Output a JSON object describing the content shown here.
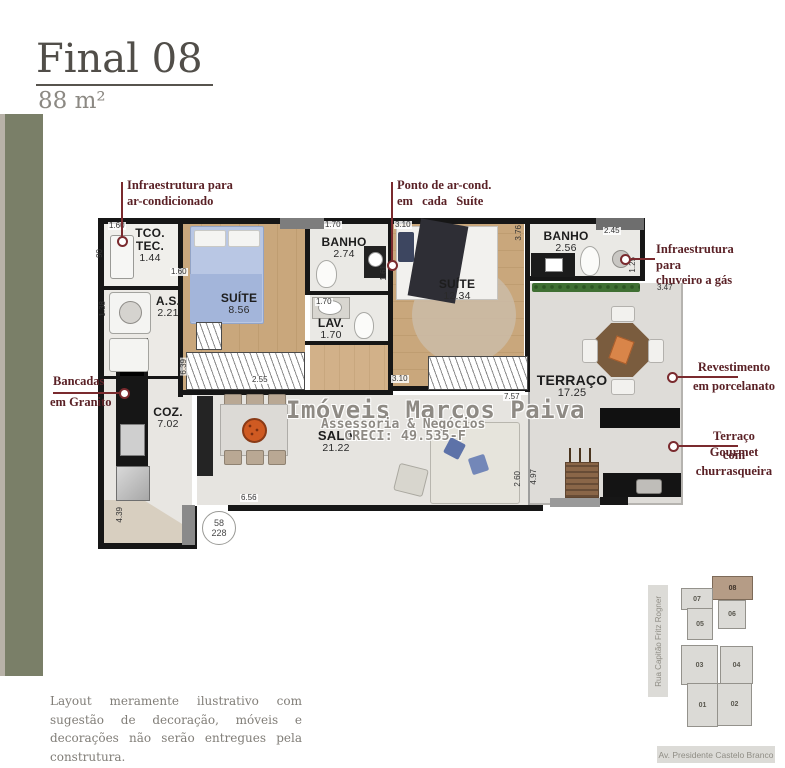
{
  "header": {
    "title": "Final 08",
    "area": "88 m²"
  },
  "watermark": {
    "line1": "Imóveis Marcos Paiva",
    "line2": "Assessoria & Negócios",
    "line3": "CRECI: 49.535-F"
  },
  "disclaimer": "Layout meramente ilustrativo com sugestão de decoração, móveis e decorações não serão entregues pela construtura.",
  "rooms": {
    "tco": {
      "name": "TCO. TEC.",
      "area": "1.44"
    },
    "as": {
      "name": "A.S.",
      "area": "2.21"
    },
    "suite1": {
      "name": "SUÍTE",
      "area": "8.56"
    },
    "banho1": {
      "name": "BANHO",
      "area": "2.74"
    },
    "lav": {
      "name": "LAV.",
      "area": "1.70"
    },
    "suite2": {
      "name": "SUÍTE",
      "area": "12.34"
    },
    "banho2": {
      "name": "BANHO",
      "area": "2.56"
    },
    "terraco": {
      "name": "TERRAÇO",
      "area": "17.25"
    },
    "coz": {
      "name": "COZ.",
      "area": "7.02"
    },
    "sala": {
      "name": "SALA",
      "area": "21.22"
    }
  },
  "dims": {
    "tco_top": "1.60",
    "tco_left": "90",
    "as_top": "1.60",
    "as_left": "1.38",
    "suite1_left": "6.39",
    "suite1_bottom": "2.55",
    "banho1_top": "1.70",
    "suite2_top": "3.10",
    "banho1_right": "1.61",
    "suite2_right": "3.76",
    "banho2_top": "2.45",
    "banho2_right": "1.25",
    "terraco_top": "3.47",
    "lav_top": "1.70",
    "hall_bottom": "3.10",
    "suite2_bottom": "7.57",
    "sala_bottom": "6.56",
    "coz_left": "4.39",
    "sala_right": "2.60",
    "terraco_left": "4.97"
  },
  "badge": {
    "top": "58",
    "bottom": "228"
  },
  "annotations": {
    "ac_infra": {
      "line1": "Infraestrutura para",
      "line2": "ar-condicionado"
    },
    "ac_point": {
      "line1": "Ponto de ar-cond.",
      "line2": "em cada Suíte"
    },
    "gas": {
      "line1": "Infraestrutura para",
      "line2": "chuveiro a gás"
    },
    "porcelain": {
      "line1": "Revestimento",
      "line2": "em porcelanato"
    },
    "gourmet": {
      "line1": "Terraço Gourmet",
      "line2": "com churrasqueira"
    },
    "granite": {
      "line1": "Bancadas",
      "line2": "em Granito"
    }
  },
  "keyplan": {
    "street_left": "Rua Capitão Fritz Rogner",
    "street_bottom": "Av. Presidente Castelo Branco",
    "units": {
      "u01": "01",
      "u02": "02",
      "u03": "03",
      "u04": "04",
      "u05": "05",
      "u06": "06",
      "u07": "07",
      "u08": "08"
    },
    "highlighted": "08"
  },
  "colors": {
    "accent_bar": "#7a7f68",
    "annotation": "#5a2126",
    "wall": "#161616",
    "highlight_unit": "#b59c86"
  }
}
